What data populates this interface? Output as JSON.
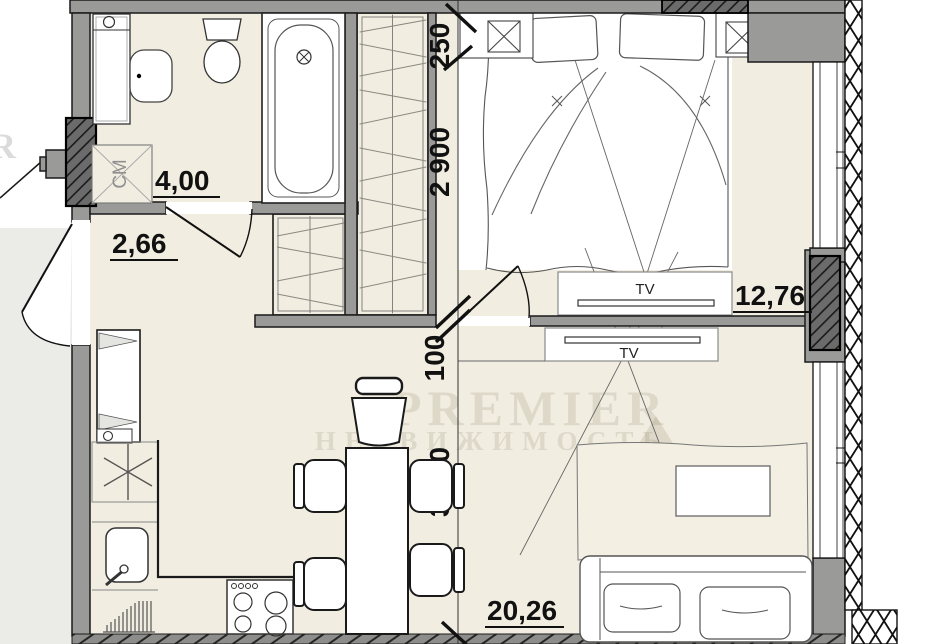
{
  "plan": {
    "type": "apartment-floor-plan",
    "rooms": [
      {
        "name": "bathroom",
        "area": "4,00"
      },
      {
        "name": "hallway",
        "area": "2,66"
      },
      {
        "name": "bedroom",
        "area": "12,76"
      },
      {
        "name": "living-kitchen",
        "area": "20,26"
      }
    ],
    "dimensions": {
      "niche": "250",
      "bedroom_width": "2 900",
      "wall": "100",
      "living_width": "3 000"
    },
    "labels": {
      "tv_bedroom": "TV",
      "tv_living": "TV",
      "washing_machine": "СМ"
    },
    "watermark": {
      "brand": "PREMIER",
      "subtitle": "НЕДВИЖИМОСТЬ",
      "edge_letter": "R"
    },
    "colors": {
      "wall": "#9a9a98",
      "floor": "#f1ede1",
      "dark_block": "#6b6b6b",
      "line": "#1a1a1a",
      "outside": "#ebebe8",
      "paper": "#ffffff"
    }
  }
}
